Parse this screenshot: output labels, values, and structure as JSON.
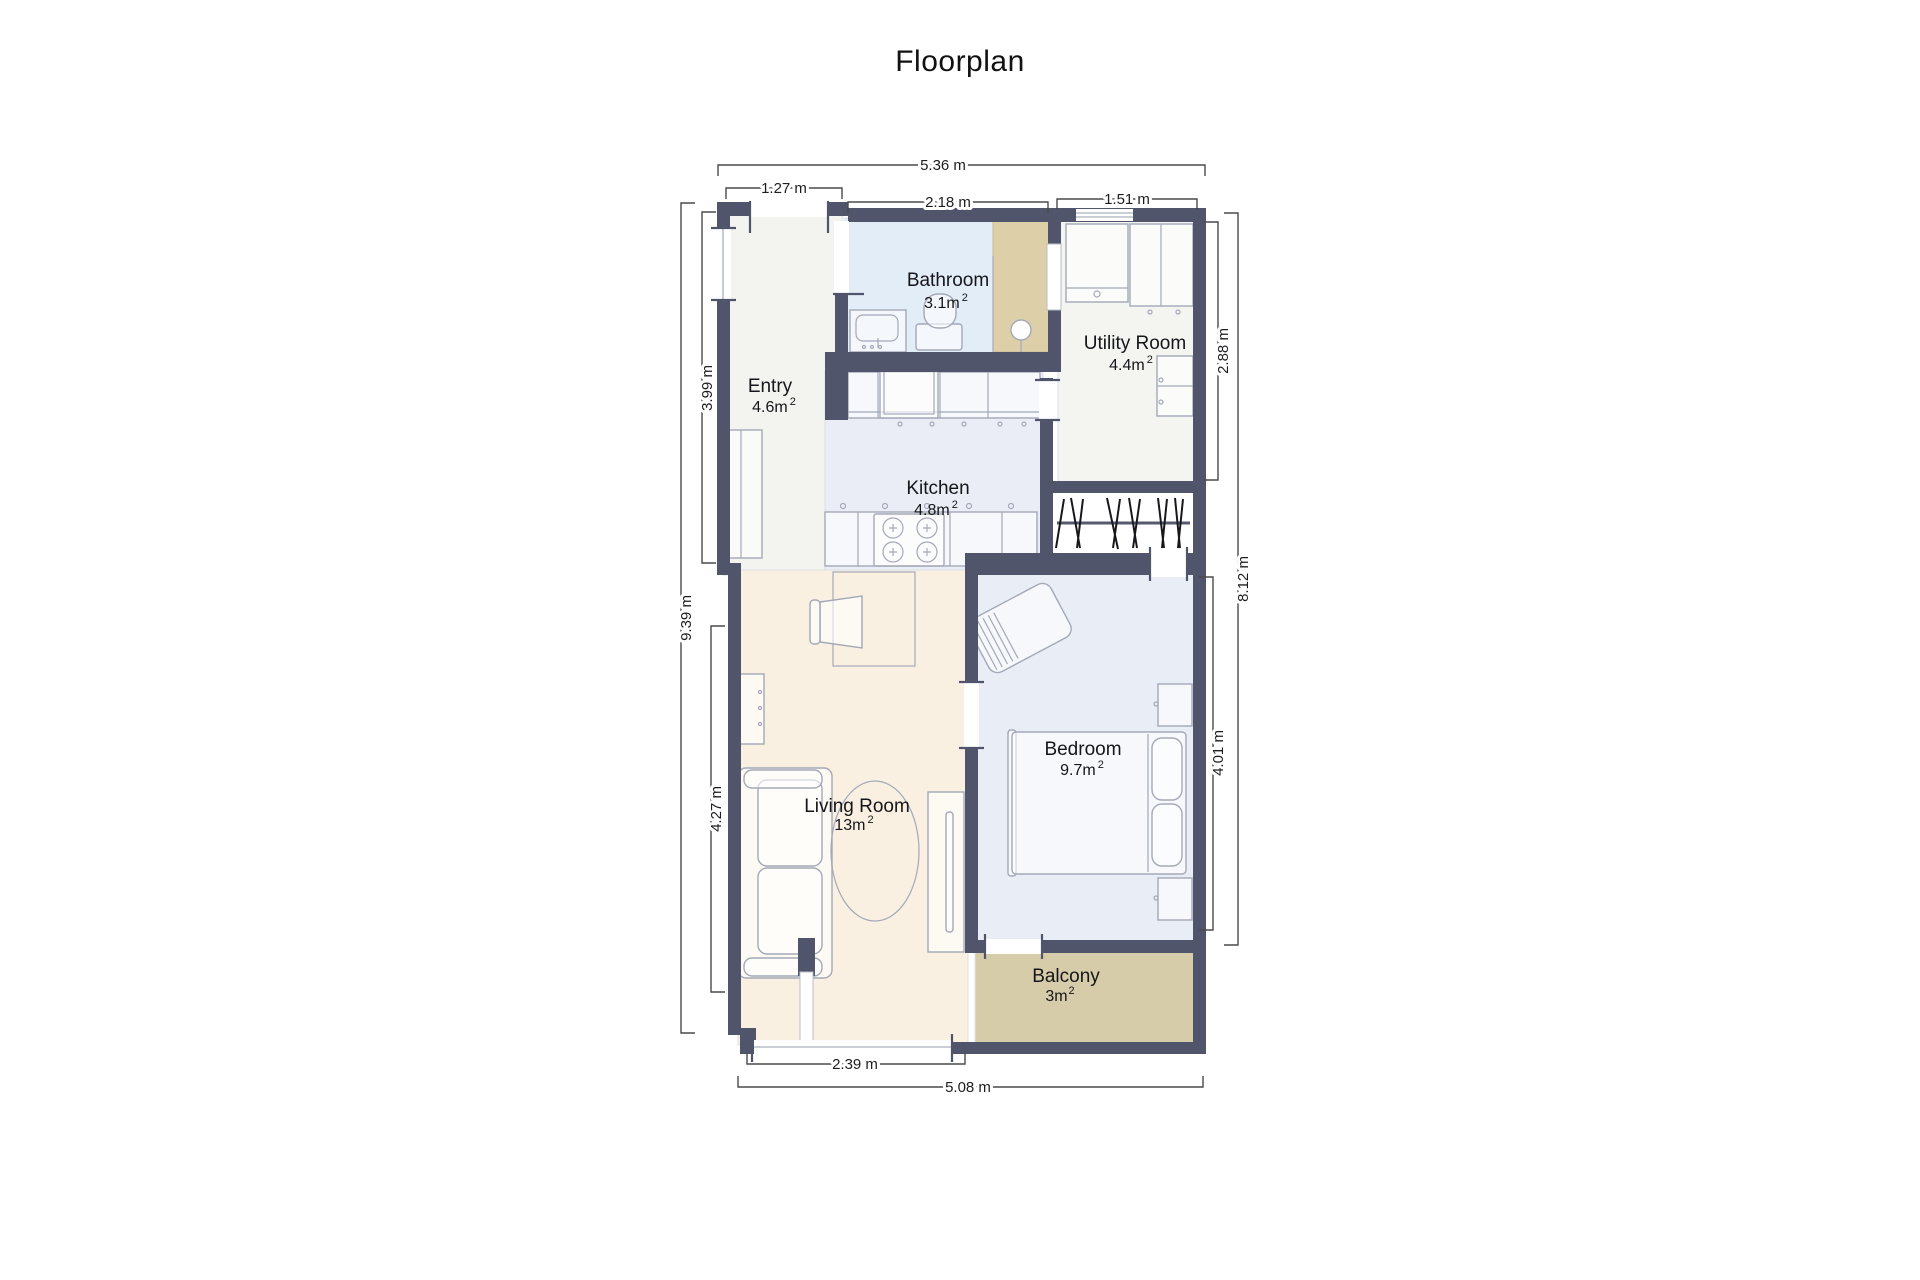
{
  "title": "Floorplan",
  "rooms": {
    "entry": {
      "label": "Entry",
      "area": "4.6m",
      "sup": "2"
    },
    "bathroom": {
      "label": "Bathroom",
      "area": "3.1m",
      "sup": "2"
    },
    "utility": {
      "label": "Utility Room",
      "area": "4.4m",
      "sup": "2"
    },
    "kitchen": {
      "label": "Kitchen",
      "area": "4.8m",
      "sup": "2"
    },
    "living": {
      "label": "Living Room",
      "area": "13m",
      "sup": "2"
    },
    "bedroom": {
      "label": "Bedroom",
      "area": "9.7m",
      "sup": "2"
    },
    "balcony": {
      "label": "Balcony",
      "area": "3m",
      "sup": "2"
    }
  },
  "dimensions": {
    "top_total": "5.36 m",
    "entry_door": "1.27 m",
    "bathroom_top": "2.18 m",
    "utility_top": "1.51 m",
    "left_total": "9.39 m",
    "entry_left": "3.99 m",
    "living_left": "4.27 m",
    "utility_right": "2.88 m",
    "bedroom_right": "4.01 m",
    "right_total": "8.12 m",
    "living_bottom": "2.39 m",
    "bottom_total": "5.08 m"
  },
  "colors": {
    "wall": "#51556c",
    "floor_entry": "#f3f3ef",
    "floor_bathroom": "#e3edf8",
    "floor_utility": "#f4f4f0",
    "floor_kitchen": "#ebedf6",
    "floor_living": "#faf0e2",
    "floor_bedroom": "#e9edf6",
    "floor_balcony": "#d7cca9",
    "shower": "#ddd0a8",
    "furniture_outline": "#a3a9b8",
    "dimension_line": "#4a4a4a",
    "text": "#1d1d1f"
  }
}
